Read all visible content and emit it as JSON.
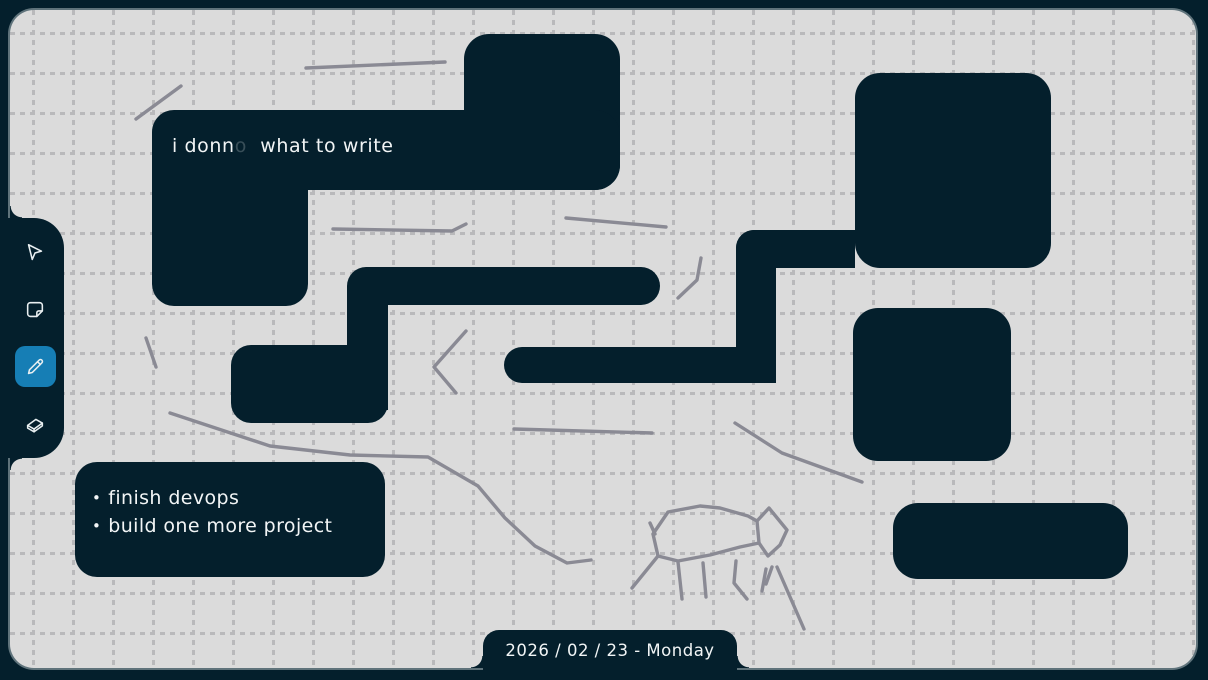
{
  "colors": {
    "ink": "#041f2c",
    "canvas": "#dbdbdb",
    "grid": "#b9b9bb",
    "pen": "#8a8a94",
    "accent": "#167eb5",
    "text": "#f2f5f6",
    "edge": "#5f737b"
  },
  "toolbar": {
    "tools": [
      {
        "name": "select",
        "icon": "cursor-icon",
        "selected": false
      },
      {
        "name": "note",
        "icon": "note-icon",
        "selected": false
      },
      {
        "name": "pencil",
        "icon": "pencil-icon",
        "selected": true
      },
      {
        "name": "eraser",
        "icon": "eraser-icon",
        "selected": false
      }
    ]
  },
  "canvas_content": {
    "notes": {
      "note1": {
        "part1": "i donn",
        "part2_faded": "o",
        "part3": "  what to write"
      },
      "todo": {
        "bullet": "•",
        "items": [
          "finish devops",
          "build one more project"
        ]
      }
    },
    "rectangles": [
      {
        "x": 464,
        "y": 34,
        "w": 156,
        "h": 156,
        "radius": "25px 25px 25px 0"
      },
      {
        "x": 152,
        "y": 110,
        "w": 468,
        "h": 80,
        "radius": "22px 25px 25px 0"
      },
      {
        "x": 152,
        "y": 178,
        "w": 156,
        "h": 128,
        "radius": "0 0 22px 22px"
      },
      {
        "x": 347,
        "y": 267,
        "w": 313,
        "h": 38,
        "radius": "19px 19px 19px 0"
      },
      {
        "x": 347,
        "y": 286,
        "w": 41,
        "h": 124,
        "radius": "0"
      },
      {
        "x": 231,
        "y": 345,
        "w": 157,
        "h": 78,
        "radius": "20px 0 20px 20px"
      },
      {
        "x": 504,
        "y": 347,
        "w": 272,
        "h": 36,
        "radius": "18px 0 0 18px"
      },
      {
        "x": 736,
        "y": 230,
        "w": 40,
        "h": 153,
        "radius": "18px 0 15px 0"
      },
      {
        "x": 736,
        "y": 230,
        "w": 119,
        "h": 38,
        "radius": "18px 0 0 0"
      },
      {
        "x": 855,
        "y": 73,
        "w": 196,
        "h": 195,
        "radius": "25px"
      },
      {
        "x": 853,
        "y": 308,
        "w": 158,
        "h": 153,
        "radius": "25px"
      },
      {
        "x": 893,
        "y": 503,
        "w": 235,
        "h": 76,
        "radius": "25px"
      },
      {
        "x": 75,
        "y": 462,
        "w": 310,
        "h": 115,
        "radius": "22px"
      }
    ],
    "strokes": [
      {
        "points": [
          [
            306,
            68
          ],
          [
            445,
            62
          ]
        ]
      },
      {
        "points": [
          [
            136,
            119
          ],
          [
            181,
            86
          ]
        ]
      },
      {
        "points": [
          [
            333,
            229
          ],
          [
            452,
            231
          ],
          [
            466,
            224
          ]
        ]
      },
      {
        "points": [
          [
            566,
            218
          ],
          [
            666,
            227
          ]
        ]
      },
      {
        "points": [
          [
            678,
            298
          ],
          [
            697,
            280
          ],
          [
            701,
            258
          ]
        ]
      },
      {
        "points": [
          [
            466,
            331
          ],
          [
            434,
            367
          ],
          [
            456,
            393
          ]
        ]
      },
      {
        "points": [
          [
            146,
            338
          ],
          [
            156,
            367
          ]
        ]
      },
      {
        "points": [
          [
            170,
            413
          ],
          [
            270,
            446
          ],
          [
            350,
            455
          ],
          [
            428,
            457
          ],
          [
            478,
            486
          ],
          [
            505,
            518
          ],
          [
            535,
            546
          ],
          [
            567,
            563
          ],
          [
            591,
            560
          ]
        ]
      },
      {
        "points": [
          [
            514,
            429
          ],
          [
            652,
            433
          ]
        ]
      },
      {
        "points": [
          [
            735,
            423
          ],
          [
            782,
            453
          ],
          [
            862,
            482
          ]
        ]
      },
      {
        "points": [
          [
            653,
            534
          ],
          [
            668,
            512
          ],
          [
            700,
            506
          ],
          [
            720,
            508
          ],
          [
            748,
            516
          ],
          [
            757,
            521
          ],
          [
            759,
            543
          ],
          [
            740,
            547
          ],
          [
            710,
            555
          ],
          [
            678,
            561
          ],
          [
            658,
            556
          ],
          [
            653,
            534
          ]
        ]
      },
      {
        "points": [
          [
            757,
            521
          ],
          [
            769,
            508
          ],
          [
            787,
            530
          ],
          [
            780,
            545
          ],
          [
            768,
            556
          ],
          [
            759,
            543
          ]
        ]
      },
      {
        "points": [
          [
            650,
            523
          ],
          [
            655,
            534
          ]
        ]
      },
      {
        "points": [
          [
            658,
            556
          ],
          [
            632,
            588
          ]
        ]
      },
      {
        "points": [
          [
            678,
            562
          ],
          [
            682,
            599
          ]
        ]
      },
      {
        "points": [
          [
            703,
            563
          ],
          [
            706,
            597
          ]
        ]
      },
      {
        "points": [
          [
            736,
            561
          ],
          [
            734,
            583
          ],
          [
            747,
            599
          ]
        ]
      },
      {
        "points": [
          [
            766,
            569
          ],
          [
            762,
            591
          ]
        ]
      },
      {
        "points": [
          [
            777,
            567
          ],
          [
            804,
            629
          ]
        ]
      },
      {
        "points": [
          [
            772,
            567
          ],
          [
            766,
            584
          ]
        ]
      }
    ]
  },
  "footer": {
    "date_label": "2026 / 02 / 23 - Monday"
  }
}
